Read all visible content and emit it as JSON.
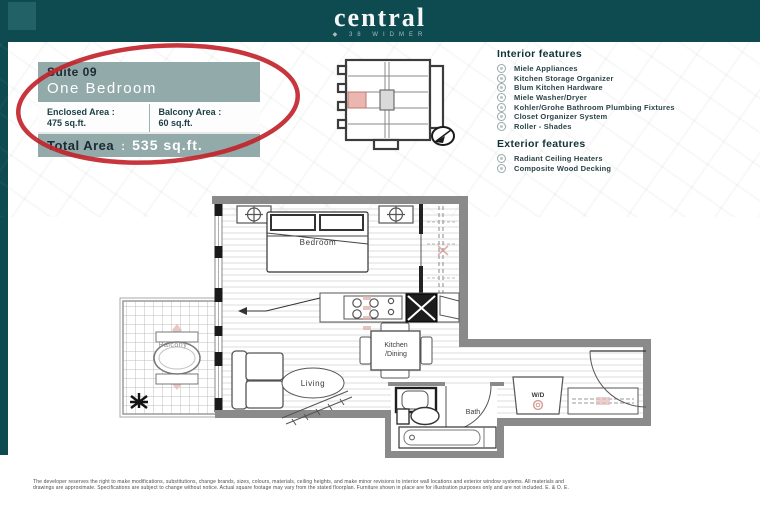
{
  "header": {
    "logo_text": "central",
    "tagline_bullet": "◆",
    "tagline": "38 WIDMER"
  },
  "suite_card": {
    "suite_label": "Suite 09",
    "suite_type": "One Bedroom",
    "enclosed_label": "Enclosed Area :",
    "enclosed_value": "475 sq.ft.",
    "balcony_label": "Balcony Area :",
    "balcony_value": "60 sq.ft.",
    "total_label": "Total Area",
    "total_sep": ":",
    "total_value": "535  sq.ft."
  },
  "features": {
    "interior_title": "Interior features",
    "interior_items": [
      "Miele Appliances",
      "Kitchen Storage Organizer",
      "Blum Kitchen Hardware",
      "Miele Washer/Dryer",
      "Kohler/Grohe Bathroom Plumbing Fixtures",
      "Closet Organizer System",
      "Roller - Shades"
    ],
    "exterior_title": "Exterior features",
    "exterior_items": [
      "Radiant Ceiling Heaters",
      "Composite Wood Decking"
    ]
  },
  "floorplan": {
    "labels": {
      "bedroom": "Bedroom",
      "balcony": "Balcony",
      "kitchen": "Kitchen",
      "dining": "/Dining",
      "living": "Living",
      "bath": "Bath",
      "wd": "W/D"
    }
  },
  "colors": {
    "header_teal": "#0e4b51",
    "card_teal": "#93aaaa",
    "annotation_red": "#c1252b",
    "keyplan_highlight": "#e9b6b0",
    "wall_gray": "#8a8a8a"
  },
  "disclaimer": {
    "line1": "The developer reserves the right to make modifications, substitutions, change brands, sizes, colours, materials, ceiling heights, and make minor revisions to interior wall locations and exterior window systems. All materials and",
    "line2": "drawings are approximate. Specifications are subject to change without notice. Actual square footage may vary from the stated floorplan. Furniture shown in place are for illustration purposes only and are not included. E. & O. E."
  }
}
